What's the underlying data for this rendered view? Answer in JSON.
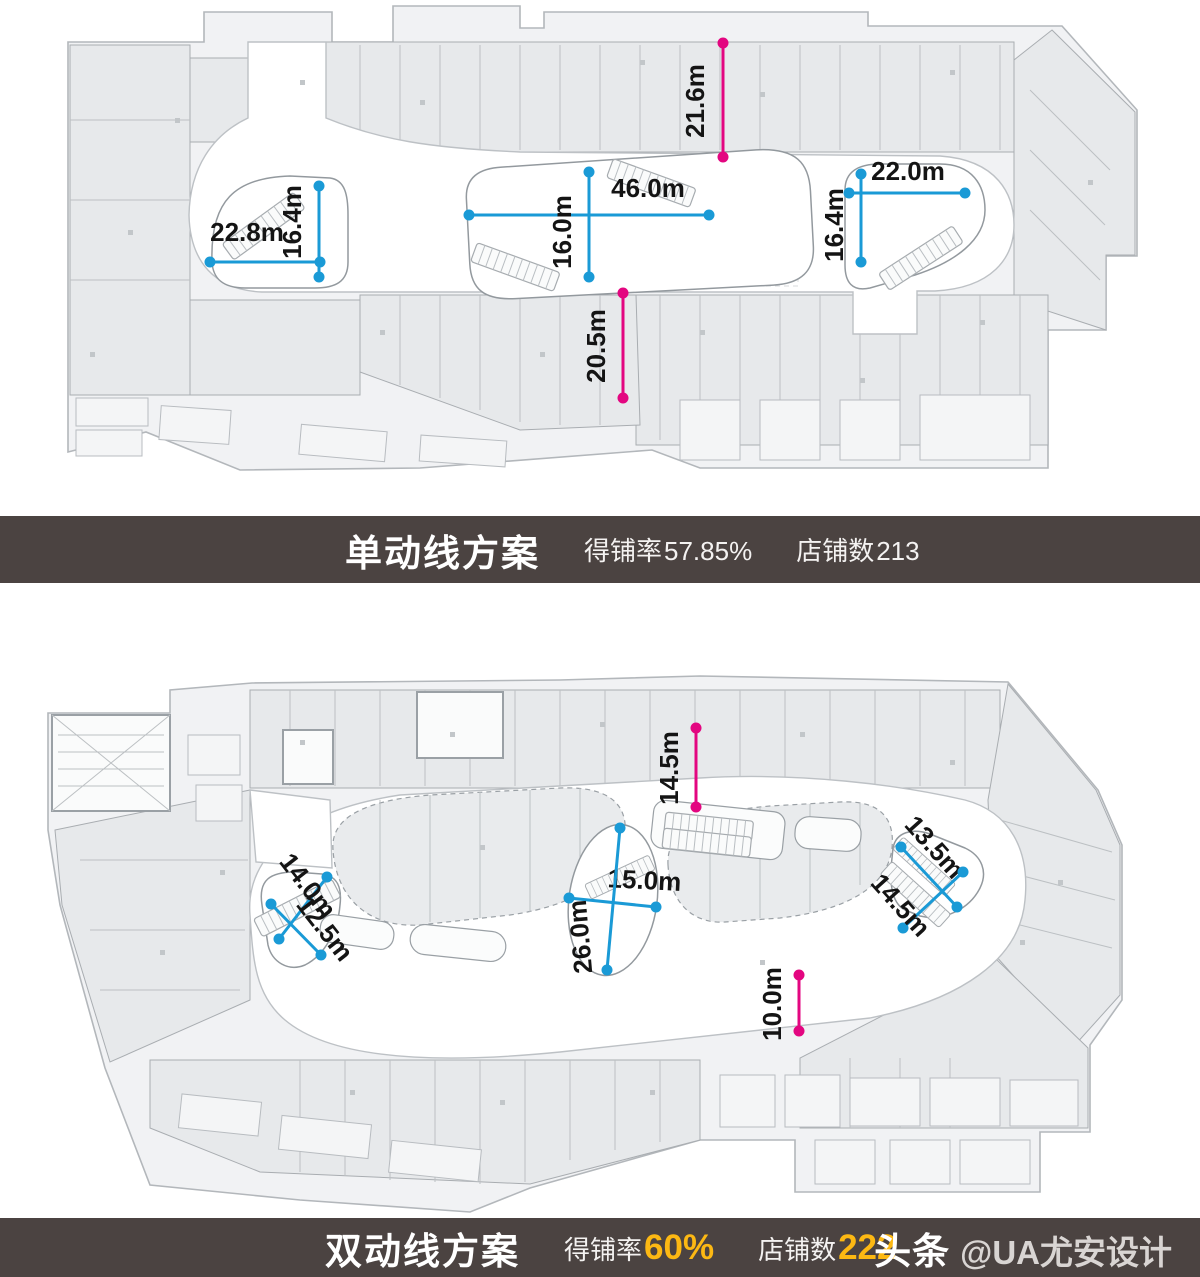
{
  "colors": {
    "blue": "#1a9ad6",
    "magenta": "#e30680",
    "banner_bg": "#4b4341",
    "accent_yellow": "#fcb813",
    "dim_text": "#141414"
  },
  "upper_banner": {
    "title": "单动线方案",
    "stat1_label": "得铺率",
    "stat1_value": "57.85%",
    "stat2_label": "店铺数",
    "stat2_value": "213"
  },
  "lower_banner": {
    "title": "双动线方案",
    "stat1_label": "得铺率",
    "stat1_value": "60%",
    "stat2_label": "店铺数",
    "stat2_value": "222",
    "watermark_brand": "头条",
    "watermark_handle": "@UA尤安设计"
  },
  "plans": {
    "upper": {
      "name": "单动线方案",
      "unit": "m",
      "dimensions": [
        {
          "label": "22.8m",
          "color": "blue",
          "x1": 210,
          "y1": 262,
          "x2": 320,
          "y2": 262,
          "lx": 247,
          "ly": 241,
          "rot": 0
        },
        {
          "label": "16.4m",
          "color": "blue",
          "x1": 319,
          "y1": 186,
          "x2": 319,
          "y2": 277,
          "lx": 301,
          "ly": 222,
          "rot": -90
        },
        {
          "label": "46.0m",
          "color": "blue",
          "x1": 469,
          "y1": 215,
          "x2": 709,
          "y2": 215,
          "lx": 648,
          "ly": 197,
          "rot": 0
        },
        {
          "label": "16.0m",
          "color": "blue",
          "x1": 589,
          "y1": 172,
          "x2": 589,
          "y2": 277,
          "lx": 571,
          "ly": 232,
          "rot": -90
        },
        {
          "label": "21.6m",
          "color": "magenta",
          "x1": 723,
          "y1": 43,
          "x2": 723,
          "y2": 157,
          "lx": 704,
          "ly": 101,
          "rot": -90
        },
        {
          "label": "20.5m",
          "color": "magenta",
          "x1": 623,
          "y1": 293,
          "x2": 623,
          "y2": 398,
          "lx": 605,
          "ly": 346,
          "rot": -90
        },
        {
          "label": "22.0m",
          "color": "blue",
          "x1": 849,
          "y1": 193,
          "x2": 965,
          "y2": 193,
          "lx": 908,
          "ly": 180,
          "rot": 0
        },
        {
          "label": "16.4m",
          "color": "blue",
          "x1": 861,
          "y1": 174,
          "x2": 861,
          "y2": 262,
          "lx": 843,
          "ly": 225,
          "rot": -90
        }
      ]
    },
    "lower": {
      "name": "双动线方案",
      "unit": "m",
      "dimensions": [
        {
          "label": "14.5m",
          "color": "magenta",
          "x1": 696,
          "y1": 728,
          "x2": 696,
          "y2": 807,
          "lx": 678,
          "ly": 768,
          "rot": -90
        },
        {
          "label": "14.0m",
          "color": "blue",
          "x1": 327,
          "y1": 877,
          "x2": 279,
          "y2": 939,
          "lx": 301,
          "ly": 891,
          "rot": 52
        },
        {
          "label": "12.5m",
          "color": "blue",
          "x1": 271,
          "y1": 904,
          "x2": 321,
          "y2": 955,
          "lx": 318,
          "ly": 934,
          "rot": 52
        },
        {
          "label": "15.0m",
          "color": "blue",
          "x1": 569,
          "y1": 898,
          "x2": 656,
          "y2": 907,
          "lx": 644,
          "ly": 889,
          "rot": 3
        },
        {
          "label": "26.0m",
          "color": "blue",
          "x1": 620,
          "y1": 828,
          "x2": 607,
          "y2": 970,
          "lx": 589,
          "ly": 936,
          "rot": -95
        },
        {
          "label": "13.5m",
          "color": "blue",
          "x1": 901,
          "y1": 847,
          "x2": 957,
          "y2": 907,
          "lx": 928,
          "ly": 853,
          "rot": 48
        },
        {
          "label": "14.5m",
          "color": "blue",
          "x1": 963,
          "y1": 872,
          "x2": 903,
          "y2": 928,
          "lx": 894,
          "ly": 911,
          "rot": 48
        },
        {
          "label": "10.0m",
          "color": "magenta",
          "x1": 799,
          "y1": 975,
          "x2": 799,
          "y2": 1031,
          "lx": 781,
          "ly": 1004,
          "rot": -90
        }
      ]
    }
  }
}
